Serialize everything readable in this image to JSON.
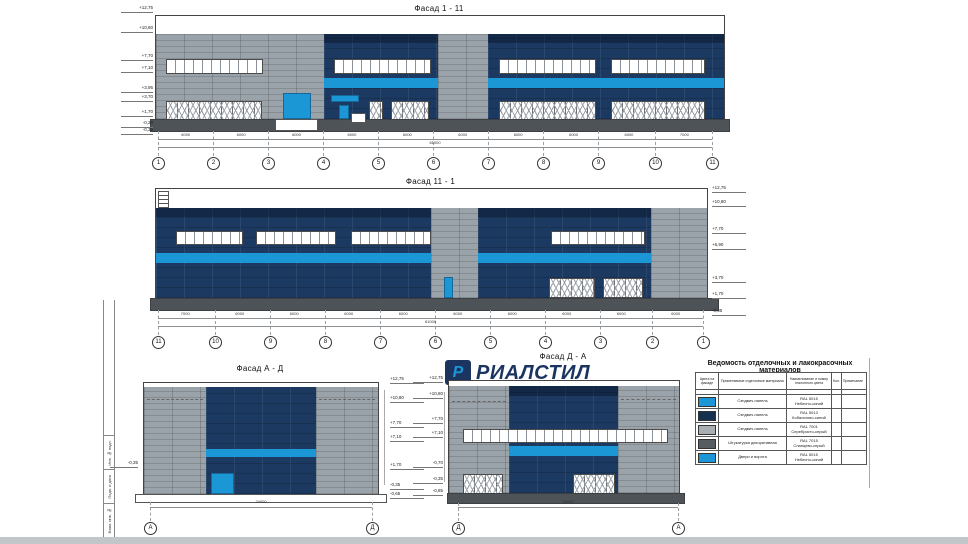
{
  "colors": {
    "navy": "#1c3a61",
    "navy_dark": "#16304f",
    "accent_blue": "#1b97d5",
    "grey_panel": "#9ba3aa",
    "plinth": "#4e5358"
  },
  "facade_1_11": {
    "title": "Фасад 1 - 11",
    "grids": [
      "1",
      "2",
      "3",
      "4",
      "5",
      "6",
      "7",
      "8",
      "9",
      "10",
      "11"
    ],
    "bay_dims": [
      "6000",
      "6000",
      "6000",
      "6000",
      "6000",
      "6000",
      "6000",
      "6000",
      "6000",
      "7000"
    ],
    "total_dim": "61000",
    "elevations_left": [
      "+12,75",
      "+10,80",
      "+7,70",
      "+7,10",
      "+3,95",
      "+3,70",
      "+1,70",
      "-0,20",
      "-0,35"
    ]
  },
  "facade_11_1": {
    "title": "Фасад 11 - 1",
    "grids": [
      "11",
      "10",
      "9",
      "8",
      "7",
      "6",
      "5",
      "4",
      "3",
      "2",
      "1"
    ],
    "bay_dims": [
      "7000",
      "6000",
      "6000",
      "6000",
      "6000",
      "6000",
      "6000",
      "6000",
      "6000",
      "6000"
    ],
    "total_dim": "61000",
    "elevations_right": [
      "+12,75",
      "+10,80",
      "+7,70",
      "+6,90",
      "+3,70",
      "+1,70",
      "-0,35"
    ]
  },
  "facade_a_d": {
    "title": "Фасад А - Д",
    "grids": [
      "А",
      "Д"
    ],
    "total_dim": "24000",
    "elevation_left": "-0,35",
    "elevations_right": [
      "+12,75",
      "+10,80",
      "+7,70",
      "+7,10",
      "+1,70",
      "-0,35",
      "-0,65"
    ]
  },
  "facade_d_a": {
    "title": "Фасад Д - А",
    "grids": [
      "Д",
      "А"
    ],
    "total_dim": "24000",
    "elevations_left": [
      "+12,75",
      "+10,80",
      "+7,70",
      "+7,10",
      "-0,70",
      "-0,35",
      "-0,85"
    ]
  },
  "logo": {
    "text": "РИАЛСТИЛ",
    "icon_letter": "Р"
  },
  "materials_table": {
    "title": "Ведомость отделочных и лакокрасочных материалов",
    "columns": [
      "Цвета на фасаде",
      "Применяемые отделочные материалы",
      "Наименование и номер эталонного цвета",
      "Кол.",
      "Примечание"
    ],
    "rows": [
      {
        "swatch": "#1b97d5",
        "material": "Сэндвич-панель",
        "color_name": "RAL 5015",
        "color_desc": "Небесно-синий"
      },
      {
        "swatch": "#16304f",
        "material": "Сэндвич-панель",
        "color_name": "RAL 5013",
        "color_desc": "Кобальтово-синий"
      },
      {
        "swatch": "#a9aeb3",
        "material": "Сэндвич-панель",
        "color_name": "RAL 7001",
        "color_desc": "Серебристо-серый"
      },
      {
        "swatch": "#575c61",
        "material": "Штукатурка декоративная",
        "color_name": "RAL 7015",
        "color_desc": "Сланцево-серый"
      },
      {
        "swatch": "#1b97d5",
        "material": "Двери и ворота",
        "color_name": "RAL 5015",
        "color_desc": "Небесно-синий"
      }
    ]
  },
  "stamp": {
    "cells": [
      "Инв. № подл.",
      "Подп. и дата",
      "Взам. инв. №"
    ]
  }
}
